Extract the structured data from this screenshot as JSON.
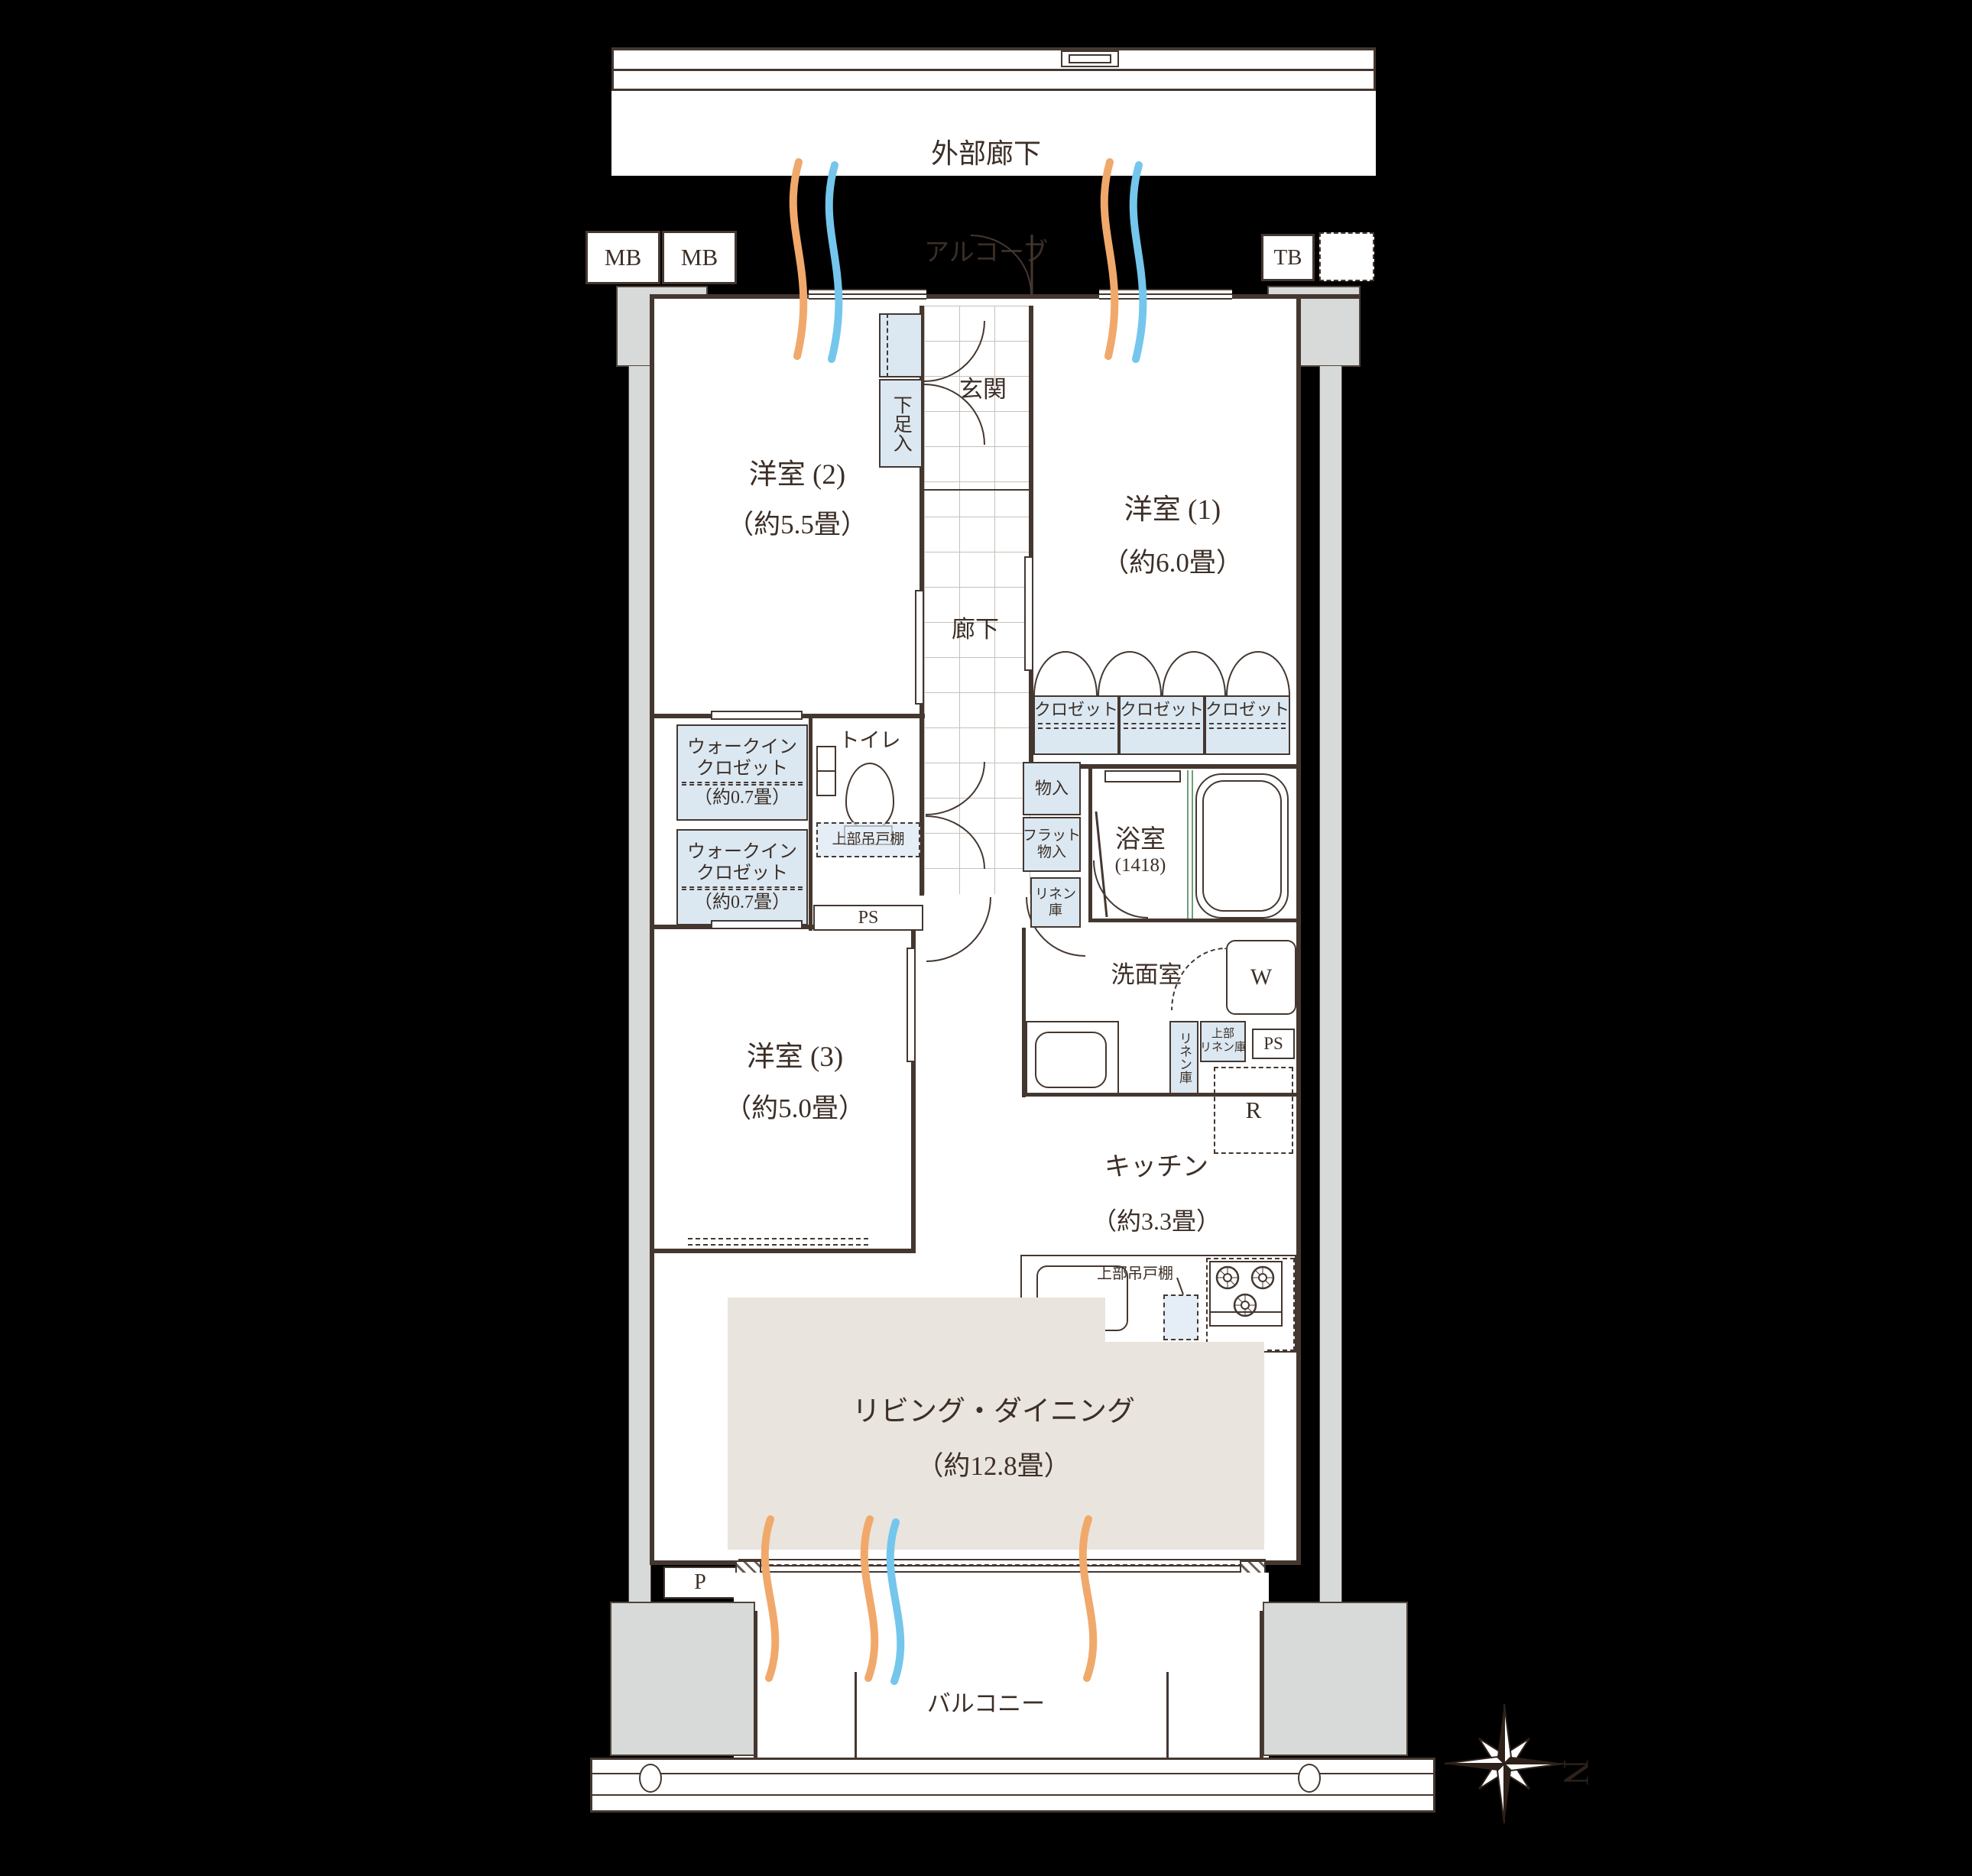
{
  "colors": {
    "accent_blue": "#dbe8f2",
    "rug_beige": "#e9e4dd",
    "wall_dark": "#443730",
    "column_gray": "#d7dad8",
    "airflow_warm": "#f0a96b",
    "airflow_cool": "#74c6ec",
    "window_green": "#6f9f7a"
  },
  "exterior": {
    "outer_corridor": "外部廊下",
    "alcove": "アルコーブ",
    "mb1": "MB",
    "mb2": "MB",
    "tb": "TB",
    "balcony": "バルコニー",
    "pipe_p": "P"
  },
  "compass": {
    "north": "N"
  },
  "rooms": {
    "western2": {
      "name": "洋室 (2)",
      "size": "（約5.5畳）"
    },
    "western1": {
      "name": "洋室 (1)",
      "size": "（約6.0畳）"
    },
    "western3": {
      "name": "洋室 (3)",
      "size": "（約5.0畳）"
    },
    "living": {
      "name": "リビング・ダイニング",
      "size": "（約12.8畳）"
    },
    "kitchen": {
      "name": "キッチン",
      "size": "（約3.3畳）"
    },
    "bath": {
      "name": "浴室",
      "size": "(1418)"
    },
    "washroom": {
      "name": "洗面室"
    },
    "entrance": {
      "name": "玄関"
    },
    "hallway": {
      "name": "廊下"
    },
    "toilet": {
      "name": "トイレ"
    }
  },
  "storage": {
    "shoe_box": "下足入",
    "wic_line1": "ウォークイン",
    "wic_line2": "クロゼット",
    "wic_size": "（約0.7畳）",
    "closet": "クロゼット",
    "storage_box": "物入",
    "flat_line1": "フラット",
    "flat_line2": "物入",
    "linen_line1": "リネン",
    "linen_line2": "庫",
    "linen_vertical": "リネン庫",
    "upper_linen_line1": "上部",
    "upper_linen_line2": "リネン庫",
    "upper_cabinet": "上部吊戸棚",
    "ps": "PS",
    "washer": "W",
    "fridge": "R"
  }
}
